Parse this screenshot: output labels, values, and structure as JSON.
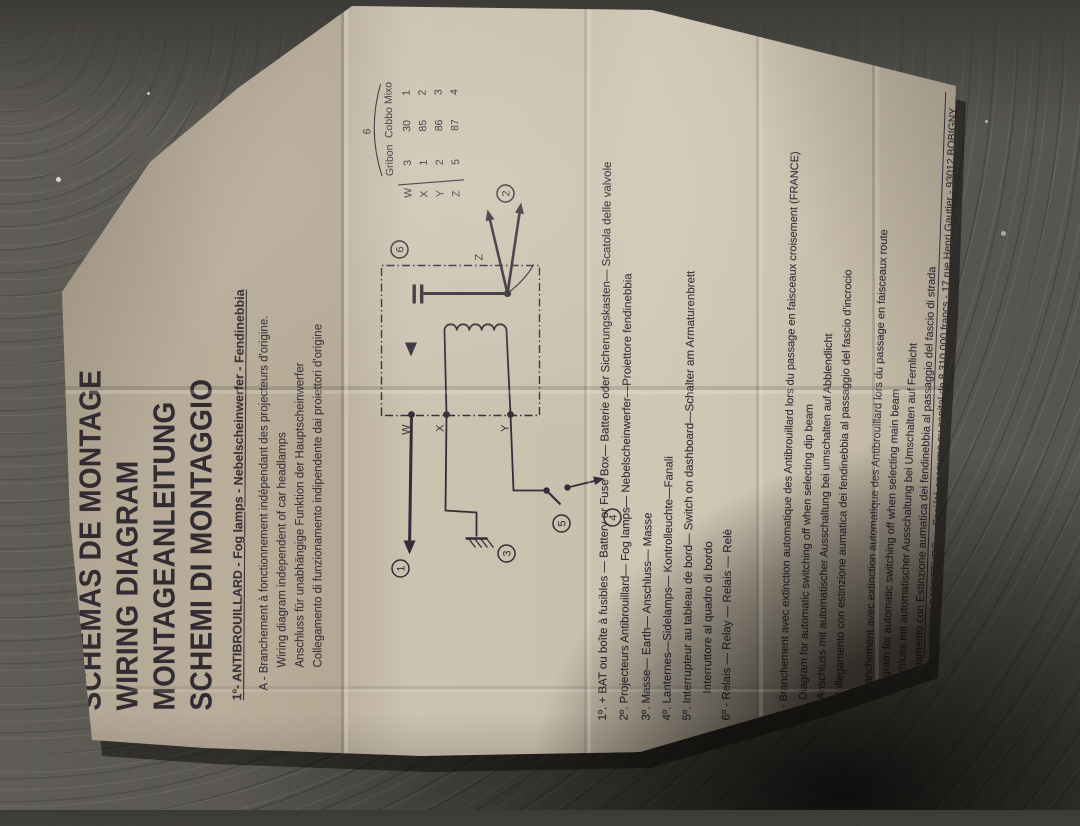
{
  "titles": {
    "line1": "SCHEMAS DE MONTAGE",
    "line2": "WIRING DIAGRAM",
    "line3": "MONTAGEANLEITUNG",
    "line4": "SCHEMI DI MONTAGGIO"
  },
  "header": "1º- ANTIBROUILLARD - Fog lamps - Nebelscheinwerfer - Fendinebbia",
  "section_a": {
    "line1": "A - Branchement à fonctionnement indépendant des projecteurs d'origine.",
    "line2": "Wiring diagram independent of car  headlamps",
    "line3": "Anschluss für unabhängige Funktion der Hauptscheinwerfer",
    "line4": "Collegamento di funzionamento indipendente dai proiettori d'origine"
  },
  "relay_table": {
    "caption": "6",
    "columns": [
      "Gribon",
      "Cobbo",
      "Mixo"
    ],
    "rows": [
      {
        "label": "W",
        "values": [
          "3",
          "30",
          "1"
        ]
      },
      {
        "label": "X",
        "values": [
          "1",
          "85",
          "2"
        ]
      },
      {
        "label": "Y",
        "values": [
          "2",
          "86",
          "3"
        ]
      },
      {
        "label": "Z",
        "values": [
          "5",
          "87",
          "4"
        ]
      }
    ]
  },
  "diagram": {
    "terminals": {
      "w": "W",
      "x": "X",
      "y": "Y",
      "z": "Z"
    },
    "nodes": {
      "n1": "1",
      "n2": "2",
      "n3": "3",
      "n4": "4",
      "n5": "5",
      "n6": "6"
    }
  },
  "items": {
    "i1": "1º. + BAT ou boîte à fusibles — Battery or Fuse Box— Batterie oder Sicherungskasten— Scatola delle valvole",
    "i2": "2º. Projecteurs Antibrouillard— Fog lamps— Nebelscheinwerfer—Proiettore fendinebbia",
    "i3": "3º. Masse— Earth— Anschluss— Masse",
    "i4": "4º. Lanternes—Sidelamps— Kontrolleuchte—Fanali",
    "i5": "5º. Interrupteur au tableau de bord— Switch on dashboard—Schalter am Armaturenbrett",
    "i5b": "Interruttore al quadro di bordo",
    "i6": "6º - Relais — Relay — Relais — Relè"
  },
  "section_b": {
    "line1": "B - Branchement avec extinction  automatique des Antibrouillard lors du passage en faisceaux croisement (FRANCE)",
    "line2": "Diagram for automatic switching off when selecting dip beam",
    "line3": "Anschluss mit automatischer Ausschaltung bei umschalten auf Abblendlicht",
    "line4": "Collegamento con estinzione aumatica dei fendinebbia al passaggio del fascio d'incrocio"
  },
  "section_c": {
    "line1": "C - Branchement avec extinction  automatique des Antibrouillard lors du passage en faisceaux route",
    "line2": "Diagram for automatic switching off when selecting main beam",
    "line3": "Anschluss mit automatischer Ausschaltung bei Umschalten auf Fernlicht",
    "line4": "Collegamento con Estinzione aumatica dei fendinebbia al passaggio del fascio di strada"
  },
  "footer": {
    "line1": "CIBIE PROJECTEURS — Société anonyme au capital de 8 310 000 francs - 17 rue Henri Gautier - 93012 BOBIGNY",
    "line2": "Téléphone 858-20-70 — Télex 21 327 F"
  }
}
